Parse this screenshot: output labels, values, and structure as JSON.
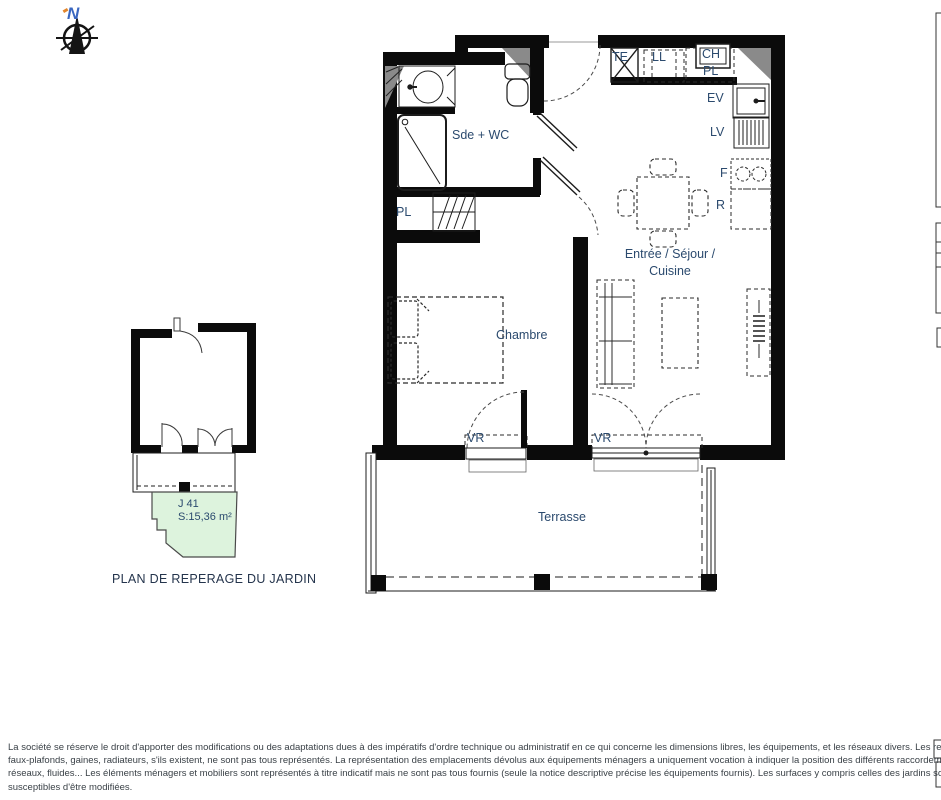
{
  "compass": {
    "north": "N"
  },
  "main_plan": {
    "rooms": {
      "bathroom": "Sde + WC",
      "bedroom": "Chambre",
      "living_line1": "Entrée / Séjour /",
      "living_line2": "Cuisine",
      "terrace": "Terrasse"
    },
    "fixtures": {
      "closet_bathroom": "PL",
      "electrical_panel": "TE",
      "washing_machine": "LL",
      "water_heater": "CH",
      "closet_entry": "PL",
      "sink": "EV",
      "dishwasher": "LV",
      "hob": "F",
      "fridge": "R",
      "window_bedroom": "VR",
      "window_living": "VR"
    }
  },
  "garden_plan": {
    "label_id": "J 41",
    "label_area": "S:15,36 m²",
    "caption": "PLAN DE REPERAGE DU JARDIN"
  },
  "disclaimer": {
    "line1": "La société se réserve le droit d'apporter des modifications ou des adaptations dues à des impératifs d'ordre technique ou administratif en ce qui concerne les dimensions libres, les équipements, et les réseaux divers. Les retombées, soffites,",
    "line2": "faux-plafonds, gaines, radiateurs, s'ils existent, ne sont pas tous représentés. La représentation des emplacements dévolus aux équipements ménagers a uniquement vocation à indiquer la position des différents raccordements nécessaires aux",
    "line3": "réseaux, fluides... Les éléments ménagers et mobiliers sont représentés à titre indicatif mais ne sont pas tous fournis (seule la notice descriptive précise les équipements fournis). Les surfaces y compris celles des jardins sont approximatives et",
    "line4": "susceptibles d'être modifiées."
  },
  "colors": {
    "wall_black": "#0b0b0b",
    "column_gray": "#8a8a8a",
    "label_navy": "#2b4a6e",
    "north_blue": "#3a67c0",
    "north_orange": "#e2862c",
    "garden_green": "#ddf3dd",
    "legal_text": "#3a4147"
  }
}
